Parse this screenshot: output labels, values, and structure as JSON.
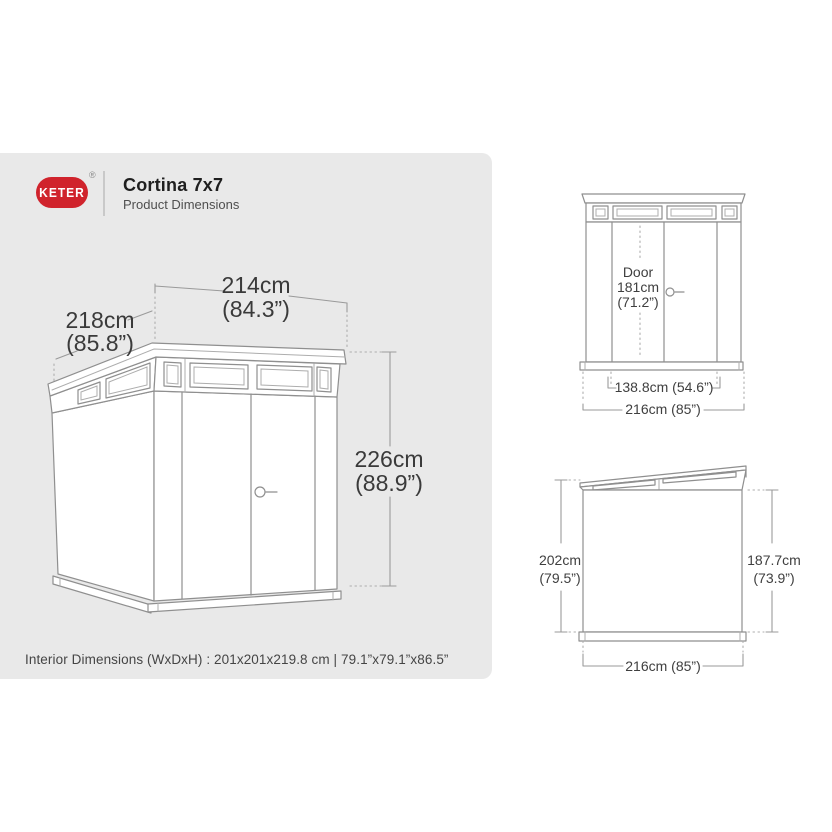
{
  "brand": {
    "logo_text": "KETER",
    "registered_mark": "®"
  },
  "header": {
    "title": "Cortina 7x7",
    "subtitle": "Product Dimensions"
  },
  "main_view": {
    "width_cm": "214cm",
    "width_in": "(84.3”)",
    "depth_cm": "218cm",
    "depth_in": "(85.8”)",
    "height_cm": "226cm",
    "height_in": "(88.9”)"
  },
  "front_view": {
    "door_word": "Door",
    "door_height_cm": "181cm",
    "door_height_in": "(71.2”)",
    "door_width": "138.8cm (54.6”)",
    "overall_width": "216cm (85”)"
  },
  "side_view": {
    "front_height_cm": "202cm",
    "front_height_in": "(79.5”)",
    "rear_height_cm": "187.7cm",
    "rear_height_in": "(73.9”)",
    "depth": "216cm (85”)"
  },
  "footer": {
    "interior_dimensions": "Interior Dimensions (WxDxH) : 201x201x219.8 cm | 79.1”x79.1”x86.5”"
  },
  "colors": {
    "logo_red": "#d0232c",
    "panel_gray": "#e9e9e9",
    "line_gray": "#8f8f8f",
    "line_light": "#adadad",
    "dim_line": "#9a9a9a",
    "text_dark": "#3a3a3a",
    "title_color": "#1f1f1f",
    "subtitle_color": "#4f4f4f"
  }
}
